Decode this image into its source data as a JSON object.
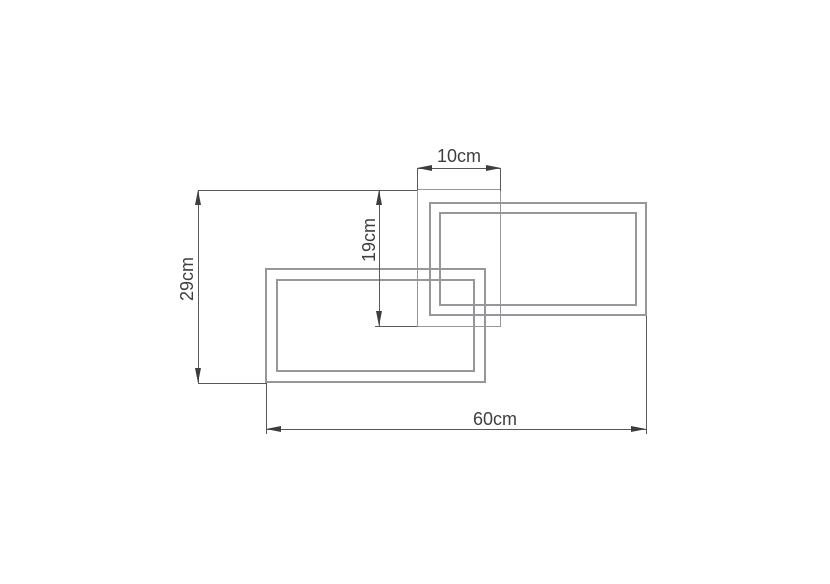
{
  "drawing": {
    "kind": "product-dimension-diagram",
    "colors": {
      "background": "#ffffff",
      "frame_outline": "#97979b",
      "dimension_line": "#58585a",
      "arrow": "#3e3e40",
      "text": "#3f3f41"
    },
    "dimensions": {
      "canopy_width": {
        "label": "10cm",
        "value": 10,
        "unit": "cm"
      },
      "inner_drop": {
        "label": "19cm",
        "value": 19,
        "unit": "cm"
      },
      "overall_height": {
        "label": "29cm",
        "value": 29,
        "unit": "cm"
      },
      "overall_width": {
        "label": "60cm",
        "value": 60,
        "unit": "cm"
      }
    }
  }
}
